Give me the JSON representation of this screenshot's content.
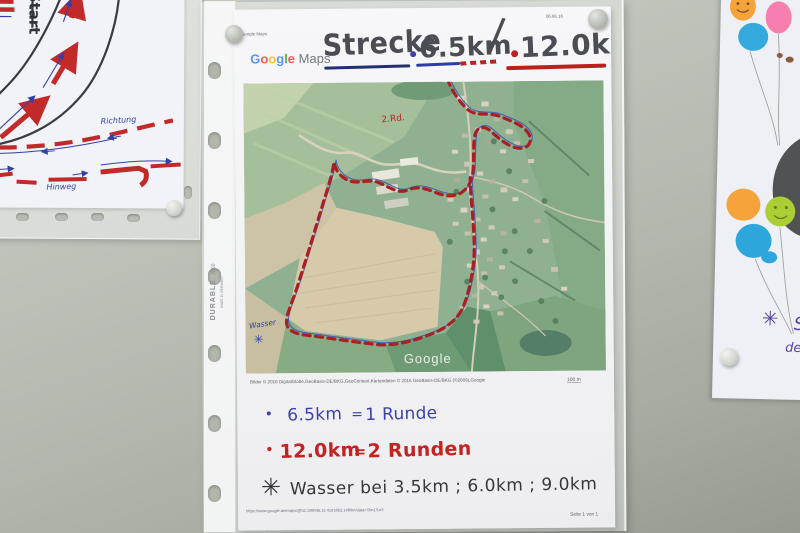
{
  "colors": {
    "route_red": "#a82023",
    "route_blue": "#3d52b5",
    "marker_blue": "#3a41ad",
    "marker_red": "#c42322",
    "marker_black": "#36363c",
    "title_gray": "#4b4c54",
    "google_blue": "#4285f4",
    "google_red": "#ea4335",
    "google_yellow": "#fbbc05",
    "google_green": "#34a853",
    "wall_gray": "#b4b8af"
  },
  "left_sketch": {
    "start_label": "Start",
    "richtung_label": "Richtung",
    "hinweg_label": "Hinweg"
  },
  "protector": {
    "brand": "DURABLE",
    "model": "2560",
    "origin": "MADE IN GERMANY"
  },
  "page": {
    "print_header": "Google Maps",
    "date": "06.06.16",
    "logo": {
      "l1": "G",
      "l2": "o",
      "l3": "o",
      "l4": "g",
      "l5": "l",
      "l6": "e",
      "suffix": "Maps"
    },
    "title": {
      "word": "Strecke",
      "d1": "6.5km",
      "slash": "/",
      "d2": "12.0km"
    },
    "map": {
      "watermark": "Google",
      "wasser": "Wasser",
      "star": "✳",
      "lap_note": "2.Rd."
    },
    "credits": "Bilder © 2016 DigitalGlobe,GeoBasis-DE/BKG,GeoContent,Kartendaten © 2016 GeoBasis-DE/BKG (©2009),Google",
    "scale": "100 m",
    "legend": [
      {
        "marker": "•",
        "distance": "6.5km",
        "eq": "=",
        "laps": "1 Runde"
      },
      {
        "marker": "•",
        "distance": "12.0km",
        "eq": "=",
        "laps": "2 Runden"
      }
    ],
    "water_note": {
      "marker": "✳",
      "text": "Wasser bei 3.5km ; 6.0km ; 9.0km"
    },
    "url": "https://www.google.de/maps/@52.198046,11.4191862,1489m/data=!3m1!1e3",
    "footer": "Seite 1 von 1"
  },
  "right_paper": {
    "star": "✳",
    "fragment_top": "S",
    "fragment_bottom": "de"
  }
}
